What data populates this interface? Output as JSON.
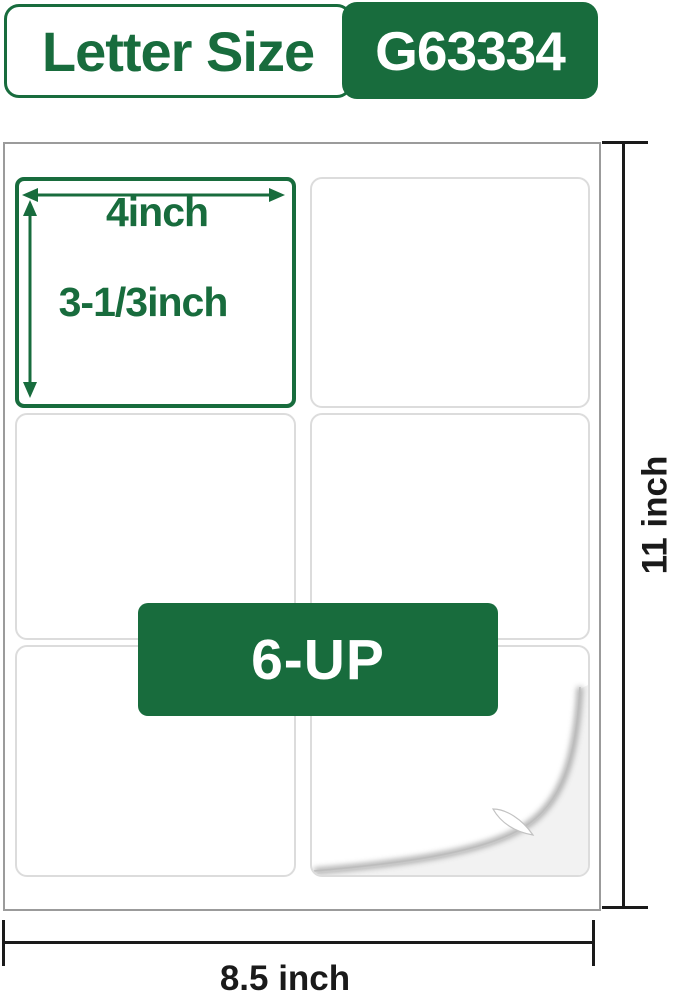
{
  "header": {
    "size_label": "Letter Size",
    "model_number": "G63334"
  },
  "sheet": {
    "highlight": {
      "width_label": "4inch",
      "height_label": "3-1/3inch"
    },
    "layout_badge": "6-UP"
  },
  "dimensions": {
    "sheet_height": "11 inch",
    "sheet_width": "8.5 inch"
  },
  "colors": {
    "brand_green": "#186C3D",
    "dimension_line": "#1a1a1a",
    "cell_border": "#dcdcdc",
    "sheet_border": "#9b9b9b",
    "curl_backing": "#f2f2f2"
  }
}
